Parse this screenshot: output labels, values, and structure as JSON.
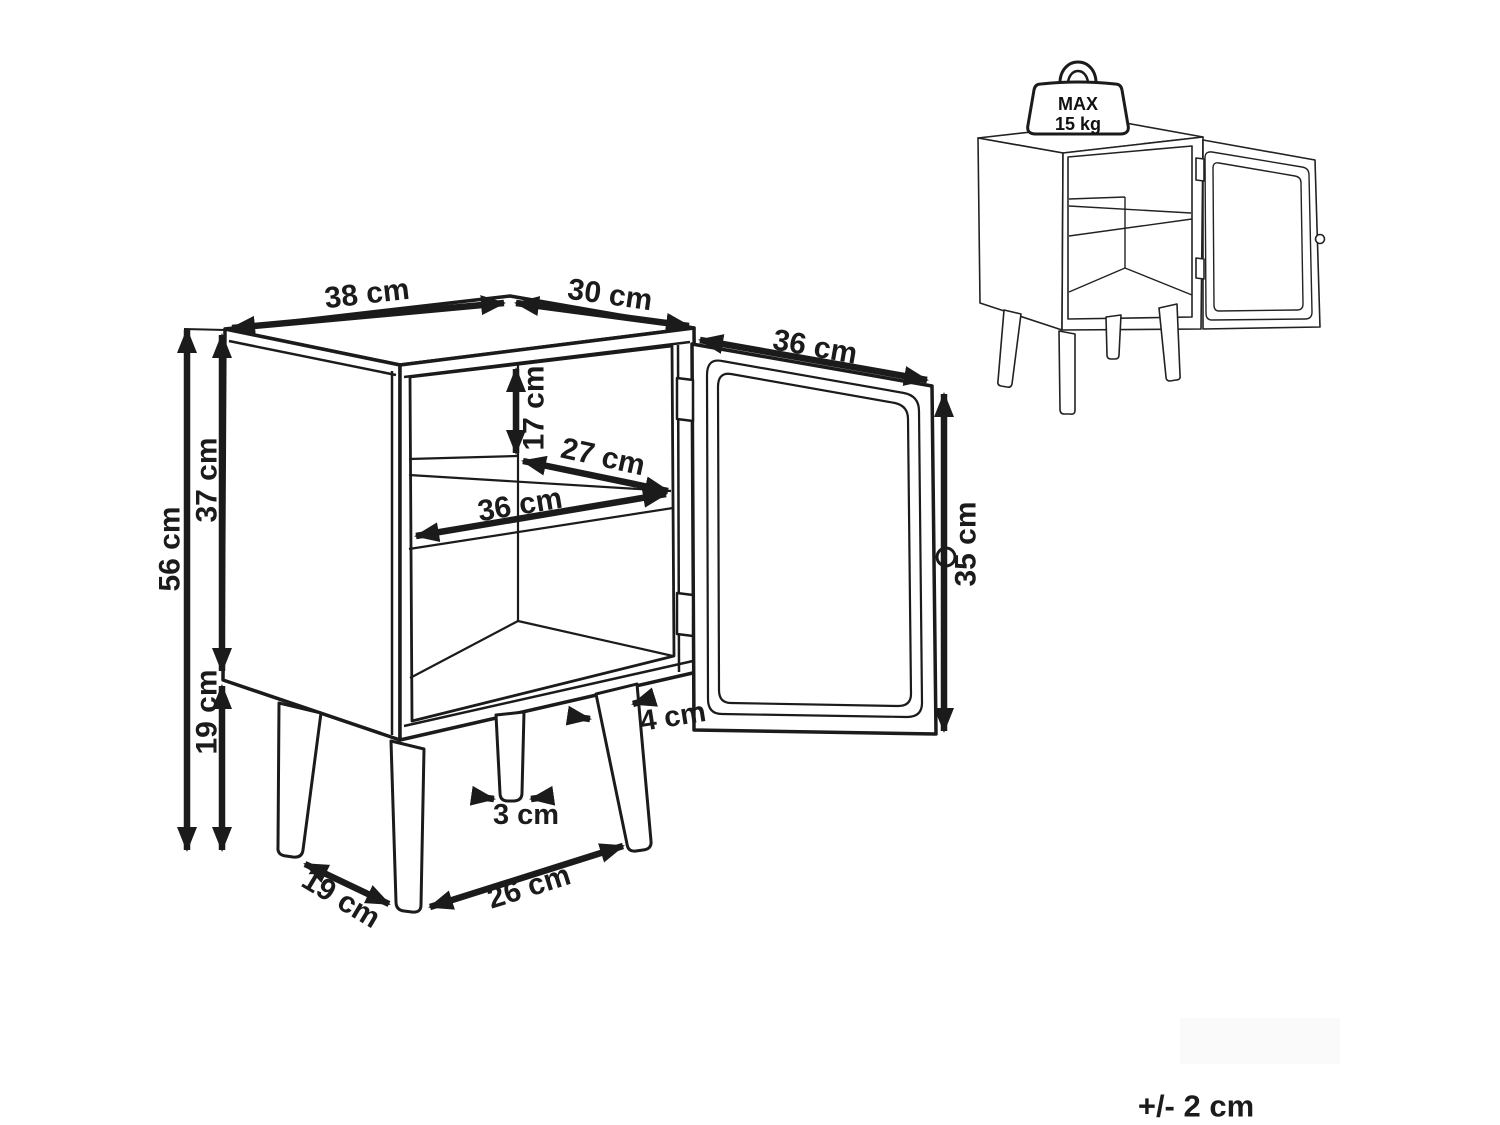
{
  "colors": {
    "line": "#1b1b1b",
    "background": "#ffffff"
  },
  "dimensions": {
    "top_width": "38 cm",
    "top_depth": "30 cm",
    "door_width": "36 cm",
    "upper_compartment_height": "17 cm",
    "shelf_depth": "27 cm",
    "shelf_width": "36 cm",
    "total_height": "56 cm",
    "body_height": "37 cm",
    "leg_height": "19 cm",
    "door_height": "35 cm",
    "leg_top_width": "4 cm",
    "leg_bottom_width": "3 cm",
    "front_leg_spacing": "26 cm",
    "side_leg_spacing": "19 cm"
  },
  "max_load": {
    "line1": "MAX",
    "line2": "15 kg"
  },
  "tolerance_note": "+/- 2 cm"
}
